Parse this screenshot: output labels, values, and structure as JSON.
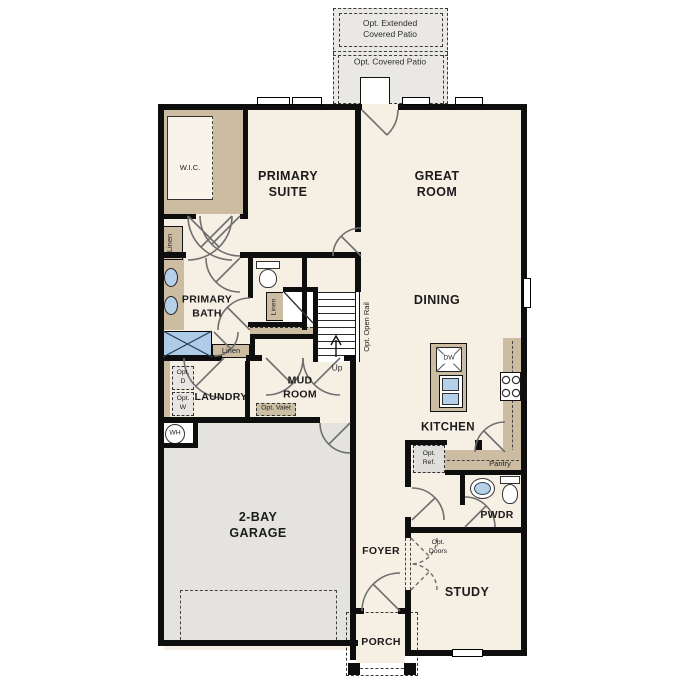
{
  "colors": {
    "wall": "#0e0e0e",
    "floor_cream": "#f6efe4",
    "garage_gray": "#e4e3e0",
    "patio_gray": "#e9e8e4",
    "cabinet_tan": "#ccbda2",
    "fixture_blue": "#b5d0e9",
    "door_arc": "#6f6f6f"
  },
  "labels": {
    "opt_extended_patio": "Opt. Extended\nCovered Patio",
    "opt_covered_patio": "Opt. Covered Patio",
    "wic": "W.I.C.",
    "primary_suite": "PRIMARY\nSUITE",
    "great_room": "GREAT\nROOM",
    "linen_hall": "Linen",
    "primary_bath": "PRIMARY\nBATH",
    "linen_stairs": "Linen",
    "linen_mud": "Linen",
    "opt_open_rail": "Opt. Open Rail",
    "up": "Up",
    "dining": "DINING",
    "opt_dryer": "Opt.\nD",
    "opt_washer": "Opt.\nW",
    "laundry": "LAUNDRY",
    "mud_room": "MUD\nROOM",
    "opt_valet": "Opt. Valet",
    "water_heater": "WH",
    "dishwasher": "DW",
    "kitchen": "KITCHEN",
    "opt_ref": "Opt.\nRef.",
    "pantry": "Pantry",
    "pwdr": "PWDR",
    "garage": "2-BAY\nGARAGE",
    "foyer": "FOYER",
    "opt_doors": "Opt.\nDoors",
    "study": "STUDY",
    "porch": "PORCH"
  }
}
